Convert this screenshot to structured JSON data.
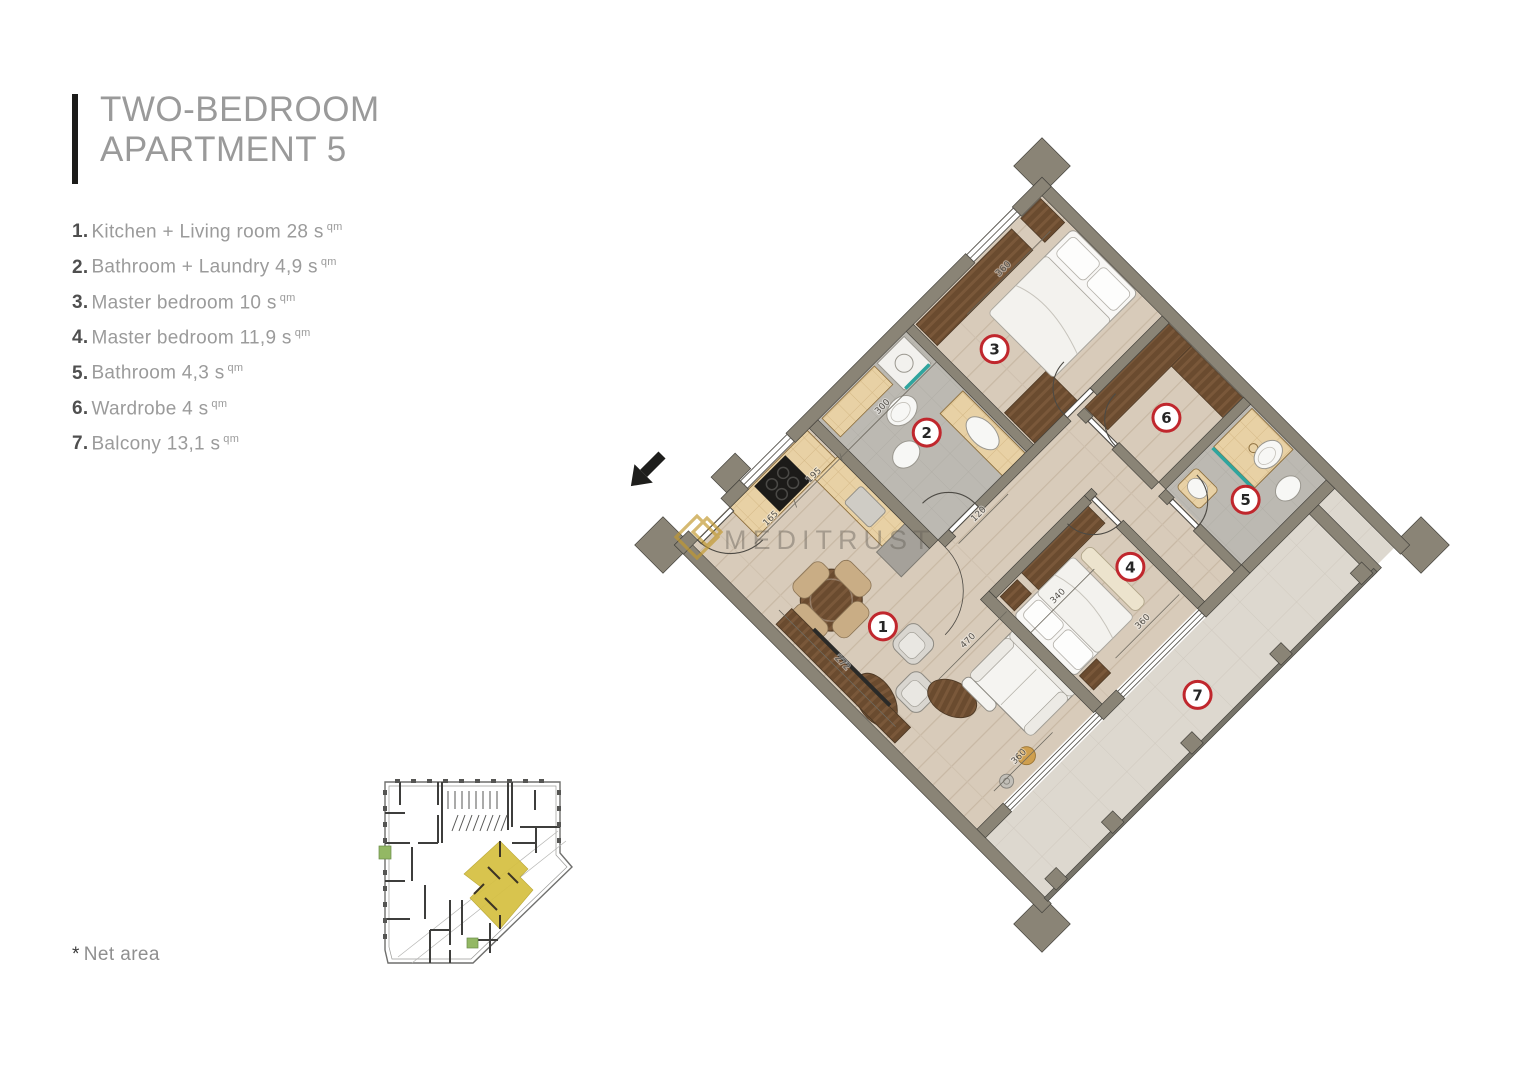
{
  "header": {
    "title_line1": "TWO-BEDROOM",
    "title_line2": "APARTMENT 5"
  },
  "legend": {
    "items": [
      {
        "num": "1.",
        "text": "Kitchen + Living room 28 s",
        "sup": "qm"
      },
      {
        "num": "2.",
        "text": "Bathroom + Laundry 4,9 s",
        "sup": "qm"
      },
      {
        "num": "3.",
        "text": "Master bedroom 10 s",
        "sup": "qm"
      },
      {
        "num": "4.",
        "text": "Master bedroom 11,9 s",
        "sup": "qm"
      },
      {
        "num": "5.",
        "text": "Bathroom 4,3 s",
        "sup": "qm"
      },
      {
        "num": "6.",
        "text": "Wardrobe 4 s",
        "sup": "qm"
      },
      {
        "num": "7.",
        "text": "Balcony 13,1 s",
        "sup": "qm"
      }
    ]
  },
  "footnote": {
    "star": "*",
    "text": "Net area"
  },
  "watermark": {
    "text": "MEDITRUST",
    "logo_color": "#c2992f"
  },
  "floorplan": {
    "badges": [
      "1",
      "2",
      "3",
      "4",
      "5",
      "6",
      "7"
    ],
    "dimensions": [
      "360",
      "300",
      "195",
      "165",
      "120",
      "272",
      "470",
      "340",
      "360",
      "360"
    ],
    "colors": {
      "wall": "#8a8476",
      "wood_floor": "#d8cbba",
      "bath_floor": "#bcb9b2",
      "balcony_floor": "#ddd8cf",
      "dark_wood": "#6a4b2f",
      "counter": "#e8d1a5",
      "badge_ring": "#c0272d",
      "teal": "#2fa59e"
    }
  }
}
